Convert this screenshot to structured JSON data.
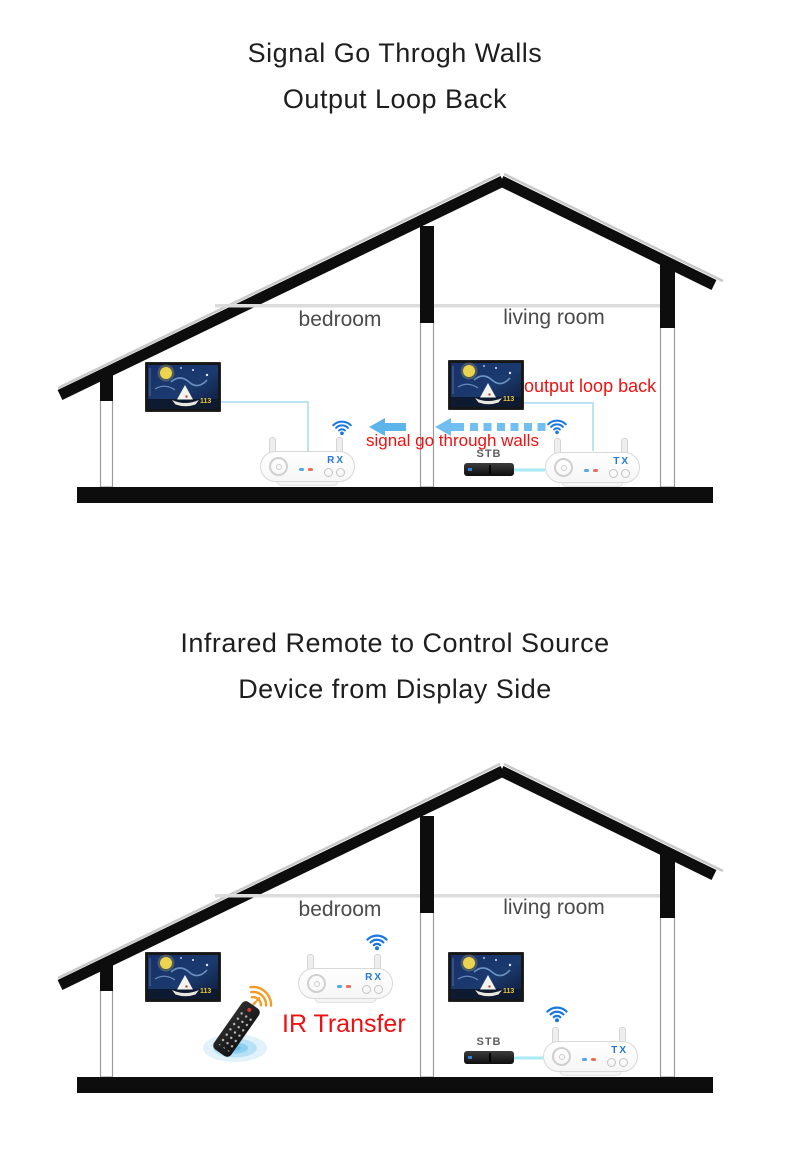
{
  "colors": {
    "accent_red": "#ee1111",
    "wifi_blue": "#1878e0",
    "device_label_blue": "#2878d6",
    "arrow_blue": "#5db4ea",
    "connection_line_blue": "#bce4f6",
    "structure_black": "#0d0d0d"
  },
  "section_walls": {
    "title_line1": "Signal Go Throgh Walls",
    "title_line2": "Output Loop Back",
    "bedroom_label": "bedroom",
    "living_room_label": "living room",
    "output_loop_back_label": "output loop back",
    "signal_label": "signal go through walls",
    "stb_label": "STB",
    "rx_label": "RX",
    "tx_label": "TX",
    "tv_badge": "113"
  },
  "section_ir": {
    "title_line1": "Infrared Remote to Control Source",
    "title_line2": "Device from Display Side",
    "bedroom_label": "bedroom",
    "living_room_label": "living room",
    "ir_label": "IR Transfer",
    "stb_label": "STB",
    "rx_label": "RX",
    "tx_label": "TX",
    "tv_badge": "113"
  }
}
